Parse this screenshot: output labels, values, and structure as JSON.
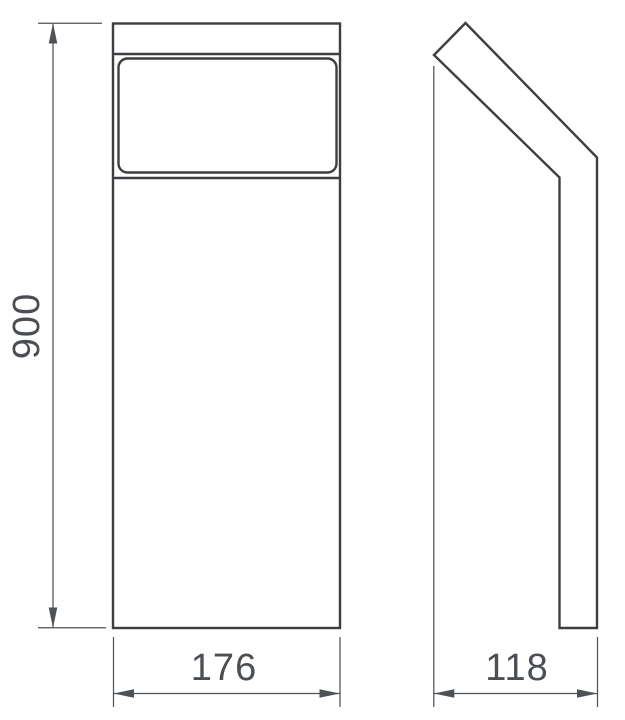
{
  "drawing": {
    "dimensions": {
      "height": "900",
      "width": "176",
      "depth": "118"
    },
    "colors": {
      "background": "#ffffff",
      "object_line": "#3c3f42",
      "dimension_line": "#4e5256",
      "label_text": "#4b4f53"
    }
  }
}
